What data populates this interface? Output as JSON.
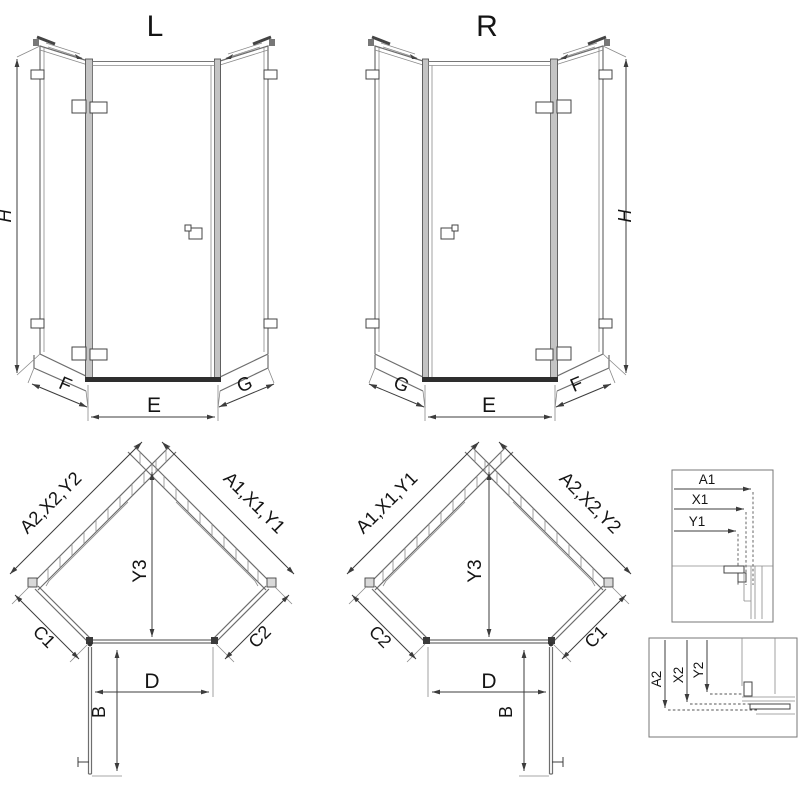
{
  "drawing": {
    "elevations": {
      "left": {
        "title": "L",
        "height_label": "H",
        "bottom_labels": [
          "F",
          "E",
          "G"
        ]
      },
      "right": {
        "title": "R",
        "height_label": "H",
        "bottom_labels": [
          "G",
          "E",
          "F"
        ]
      }
    },
    "plans": {
      "left": {
        "wall_upper_left": "A2,X2,Y2",
        "wall_upper_right": "A1,X1,Y1",
        "depth_label": "Y3",
        "side_left": "C1",
        "side_right": "C2",
        "door_label": "D",
        "door_swing_label": "B"
      },
      "right": {
        "wall_upper_left": "A1,X1,Y1",
        "wall_upper_right": "A2,X2,Y2",
        "depth_label": "Y3",
        "side_left": "C2",
        "side_right": "C1",
        "door_label": "D",
        "door_swing_label": "B"
      }
    },
    "details": {
      "top": {
        "labels": [
          "A1",
          "X1",
          "Y1"
        ]
      },
      "bottom": {
        "labels": [
          "A2",
          "X2",
          "Y2"
        ]
      }
    },
    "colors": {
      "background": "#ffffff",
      "line": "#6e6e6e",
      "dark": "#2e2e2e",
      "dimension": "#3c3c3c",
      "text": "#141414"
    }
  }
}
